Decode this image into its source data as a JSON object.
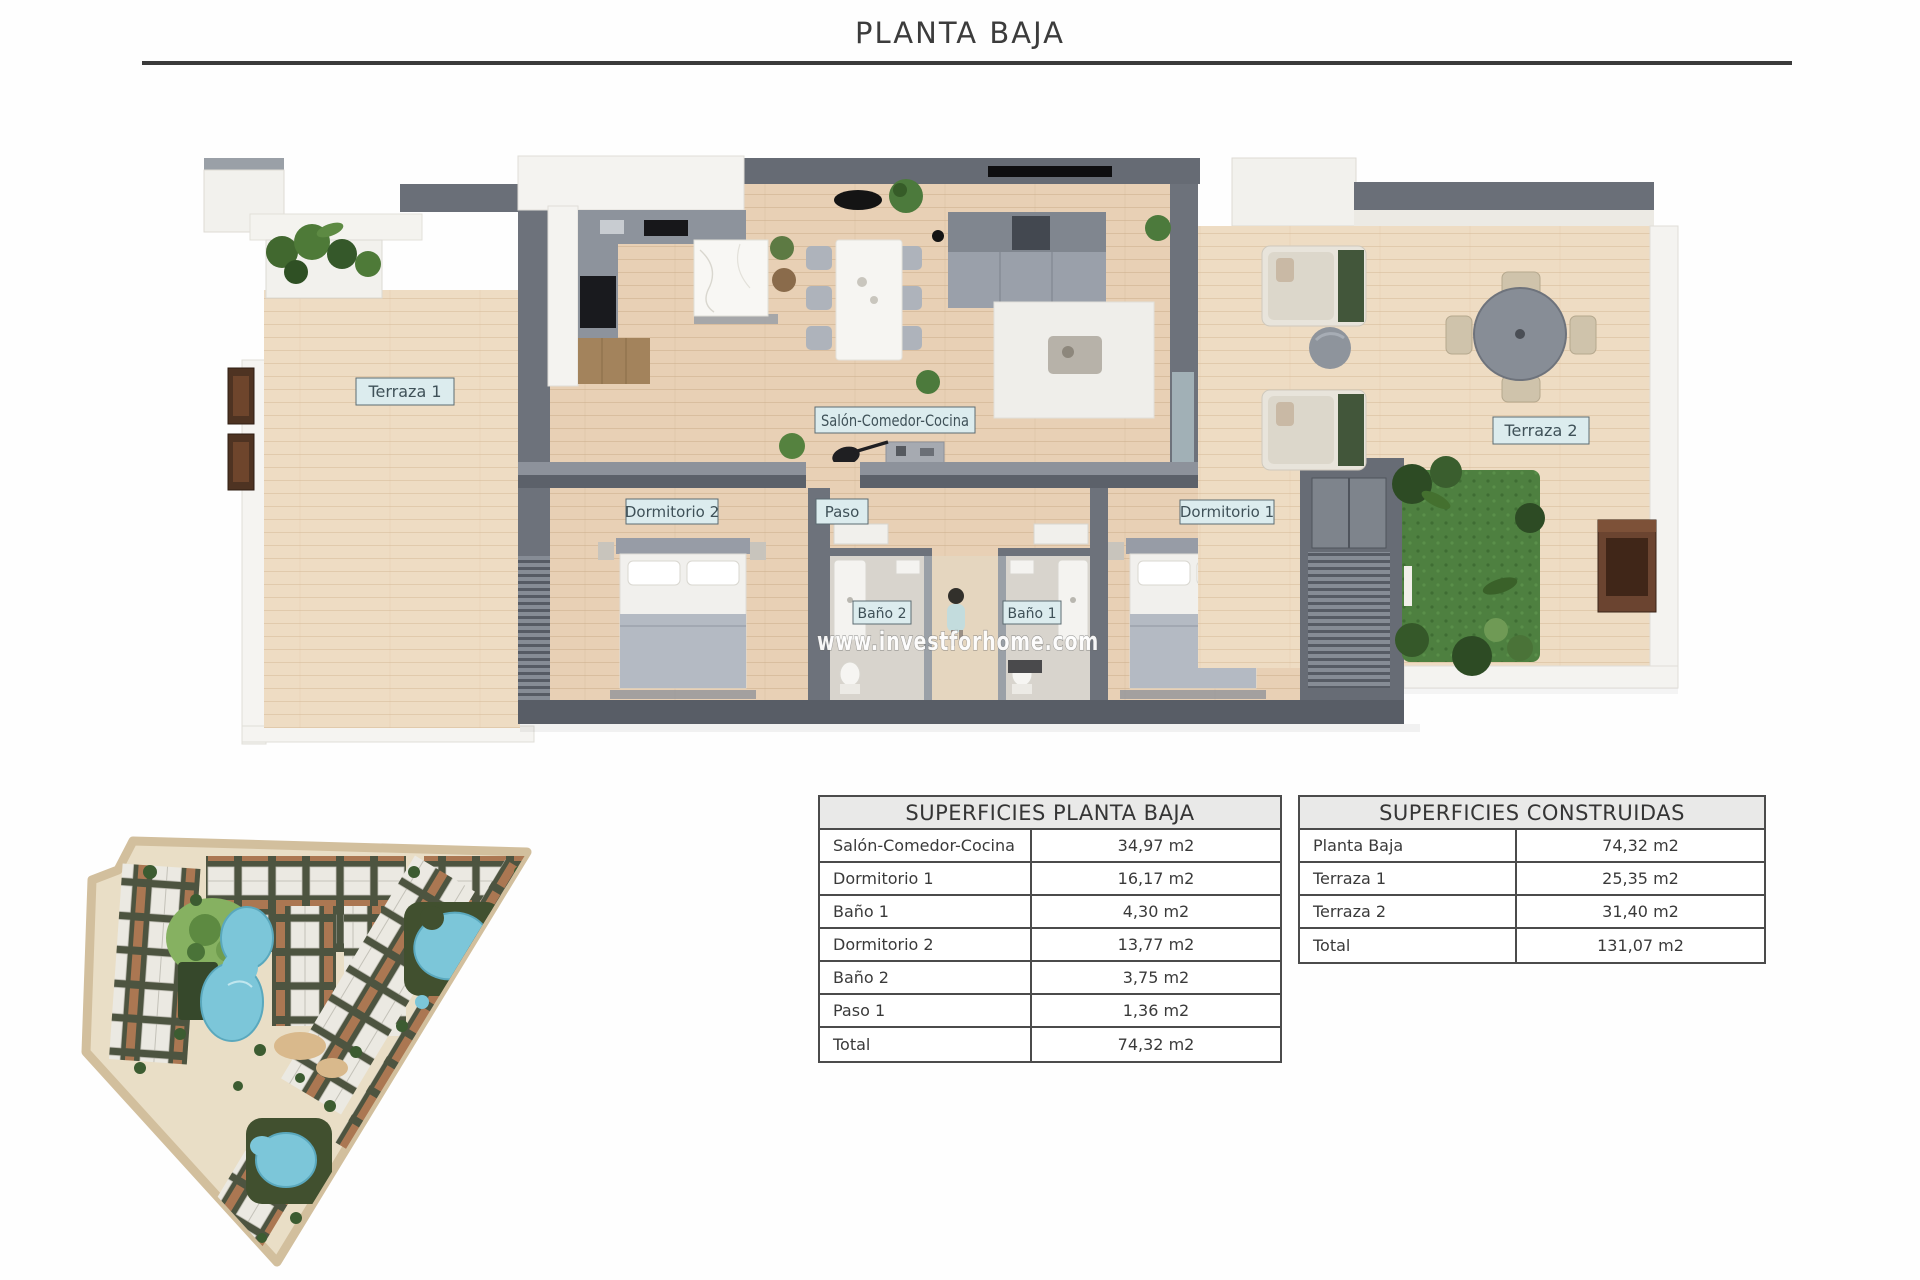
{
  "title": "PLANTA BAJA",
  "watermark": "www.investforhome.com",
  "plan_labels": {
    "terraza1": "Terraza 1",
    "salon": "Salón-Comedor-Cocina",
    "dormitorio2": "Dormitorio 2",
    "paso": "Paso",
    "dormitorio1": "Dormitorio 1",
    "bano2": "Baño 2",
    "bano1": "Baño 1",
    "terraza2": "Terraza 2"
  },
  "tables": {
    "planta_baja": {
      "title": "SUPERFICIES PLANTA BAJA",
      "rows": [
        {
          "label": "Salón-Comedor-Cocina",
          "value": "34,97 m2"
        },
        {
          "label": "Dormitorio 1",
          "value": "16,17 m2"
        },
        {
          "label": "Baño 1",
          "value": "4,30 m2"
        },
        {
          "label": "Dormitorio 2",
          "value": "13,77 m2"
        },
        {
          "label": "Baño 2",
          "value": "3,75 m2"
        },
        {
          "label": "Paso 1",
          "value": "1,36 m2"
        },
        {
          "label": "Total",
          "value": "74,32 m2"
        }
      ]
    },
    "construidas": {
      "title": "SUPERFICIES CONSTRUIDAS",
      "rows": [
        {
          "label": "Planta Baja",
          "value": "74,32 m2"
        },
        {
          "label": "Terraza 1",
          "value": "25,35 m2"
        },
        {
          "label": "Terraza 2",
          "value": "31,40 m2"
        },
        {
          "label": "Total",
          "value": "131,07 m2"
        }
      ]
    }
  },
  "colors": {
    "wood": "#e8d0b5",
    "wood2": "#eedcc3",
    "wall": "#6d727b",
    "wall-dark": "#5c616a",
    "label-bg": "#dcecee",
    "label-border": "#5c6b72",
    "label-text": "#3f5158",
    "grass": "#4e8040",
    "pool": "#7cc6d9",
    "line": "#4b4b4b",
    "title": "#3c3c3c"
  }
}
